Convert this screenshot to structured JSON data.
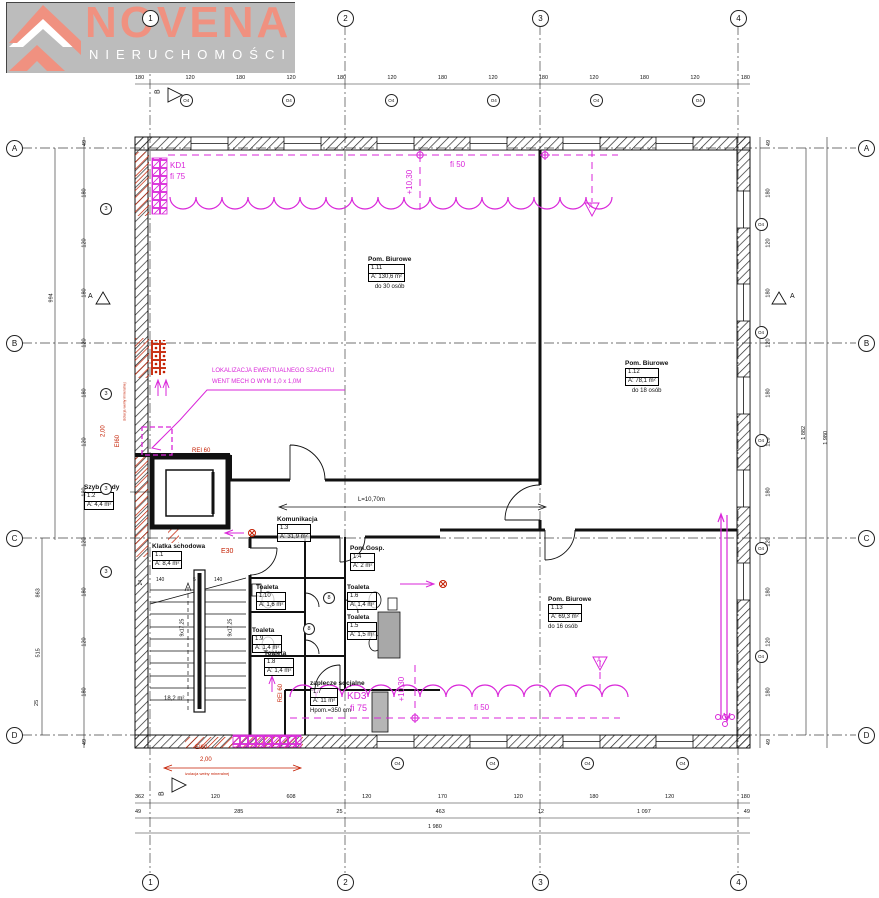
{
  "logo": {
    "brand": "NOVENA",
    "subtitle": "NIERUCHOMOŚCI"
  },
  "grid": {
    "cols": [
      "1",
      "2",
      "3",
      "4"
    ],
    "rows": [
      "A",
      "B",
      "C",
      "D"
    ]
  },
  "section_markers": {
    "top": "B",
    "bottom": "B",
    "left": "A",
    "right": "A"
  },
  "rooms": [
    {
      "name": "Pom. Biurowe",
      "num": "1.11",
      "area": "A: 130,6 m²",
      "note": "do 30 osób"
    },
    {
      "name": "Pom. Biurowe",
      "num": "1.12",
      "area": "A: 78,1 m²",
      "note": "do 18 osób"
    },
    {
      "name": "Pom. Biurowe",
      "num": "1.13",
      "area": "A: 69,3 m²",
      "note": "do 16 osób"
    },
    {
      "name": "Szyb windy",
      "num": "1.2",
      "area": "A: 4,4 m²",
      "note": ""
    },
    {
      "name": "Klatka schodowa",
      "num": "1.1",
      "area": "A: 8,4 m²",
      "note": ""
    },
    {
      "name": "Komunikacja",
      "num": "1.3",
      "area": "A: 31,9 m²",
      "note": ""
    },
    {
      "name": "Pom.Gosp.",
      "num": "1.4",
      "area": "A: 2 m²",
      "note": ""
    },
    {
      "name": "Toaleta",
      "num": "1.10",
      "area": "A: 1,6 m²",
      "note": ""
    },
    {
      "name": "Toaleta",
      "num": "1.6",
      "area": "A: 1,4 m²",
      "note": ""
    },
    {
      "name": "Toaleta",
      "num": "1.9",
      "area": "A: 1,4 m²",
      "note": ""
    },
    {
      "name": "Toaleta",
      "num": "1.5",
      "area": "A: 1,5 m²",
      "note": ""
    },
    {
      "name": "Toaleta",
      "num": "1.8",
      "area": "A: 1,4 m²",
      "note": ""
    },
    {
      "name": "zaplecze socjalne",
      "num": "1.7",
      "area": "A: 11 m²",
      "note": "Hpom.=350 cm"
    }
  ],
  "stairs": {
    "run1": "9x17,25",
    "run2": "9x17,25",
    "area": "18,2 m²",
    "dims": [
      "24",
      "140",
      "5",
      "140"
    ]
  },
  "annotations": {
    "magenta": {
      "kd1": "KD1",
      "kd1_fi": "fi 75",
      "level_top": "+10,30",
      "fi_top": "fi 50",
      "szacht_line1": "LOKALIZACJA EWENTUALNEGO SZACHTU",
      "szacht_line2": "WENT MECH O WYM 1,0 x 1,0M",
      "level_bottom": "+10,30",
      "fi_bottom": "fi 50",
      "kd3": "KD3",
      "kd3_fi": "fi 75",
      "detail_a": "A"
    },
    "fire": {
      "rei60_lift": "REI 60",
      "e30": "E30",
      "rei60_stair": "REI 60",
      "left_len": "2,00",
      "left_class": "EI60",
      "left_note": "izolacja wełny mineralnej",
      "bottom_class": "EI60",
      "bottom_len": "2,00",
      "bottom_note": "izolacja wełny mineralnej"
    },
    "corridor_length": "L=10,70m"
  },
  "dimensions": {
    "top_chain": [
      "180",
      "120",
      "180",
      "120",
      "180",
      "120",
      "180",
      "120",
      "180",
      "120",
      "180",
      "120",
      "180"
    ],
    "bottom_chain_1": [
      "362",
      "120",
      "608",
      "120",
      "170",
      "120",
      "180",
      "120",
      "180"
    ],
    "bottom_chain_2": [
      "49",
      "285",
      "25",
      "463",
      "12",
      "1 097",
      "49"
    ],
    "bottom_total": "1 980",
    "left_chain": [
      "49",
      "180",
      "120",
      "180",
      "120",
      "180",
      "120",
      "180",
      "120",
      "180",
      "120",
      "180",
      "49"
    ],
    "left_totals": [
      "994",
      "863",
      "515",
      "25"
    ],
    "right_chain": [
      "49",
      "180",
      "120",
      "180",
      "120",
      "180",
      "120",
      "180",
      "120",
      "180",
      "120",
      "180",
      "49"
    ],
    "right_totals": [
      "1 882",
      "1 980"
    ]
  },
  "windows": {
    "top": [
      "O4",
      "O4",
      "O4",
      "O4",
      "O4",
      "O4"
    ],
    "right": [
      "O4",
      "O4",
      "O4",
      "O4",
      "O4"
    ],
    "bottom": [
      "O4",
      "O4",
      "O4",
      "O4"
    ]
  },
  "wall_markers": [
    "3",
    "3",
    "3",
    "3"
  ],
  "door_markers": [
    "8",
    "8"
  ],
  "colors": {
    "magenta": "#d926d9",
    "red": "#c41e00",
    "logo_salmon": "#f09180",
    "logo_gray": "#bcbcbc"
  }
}
